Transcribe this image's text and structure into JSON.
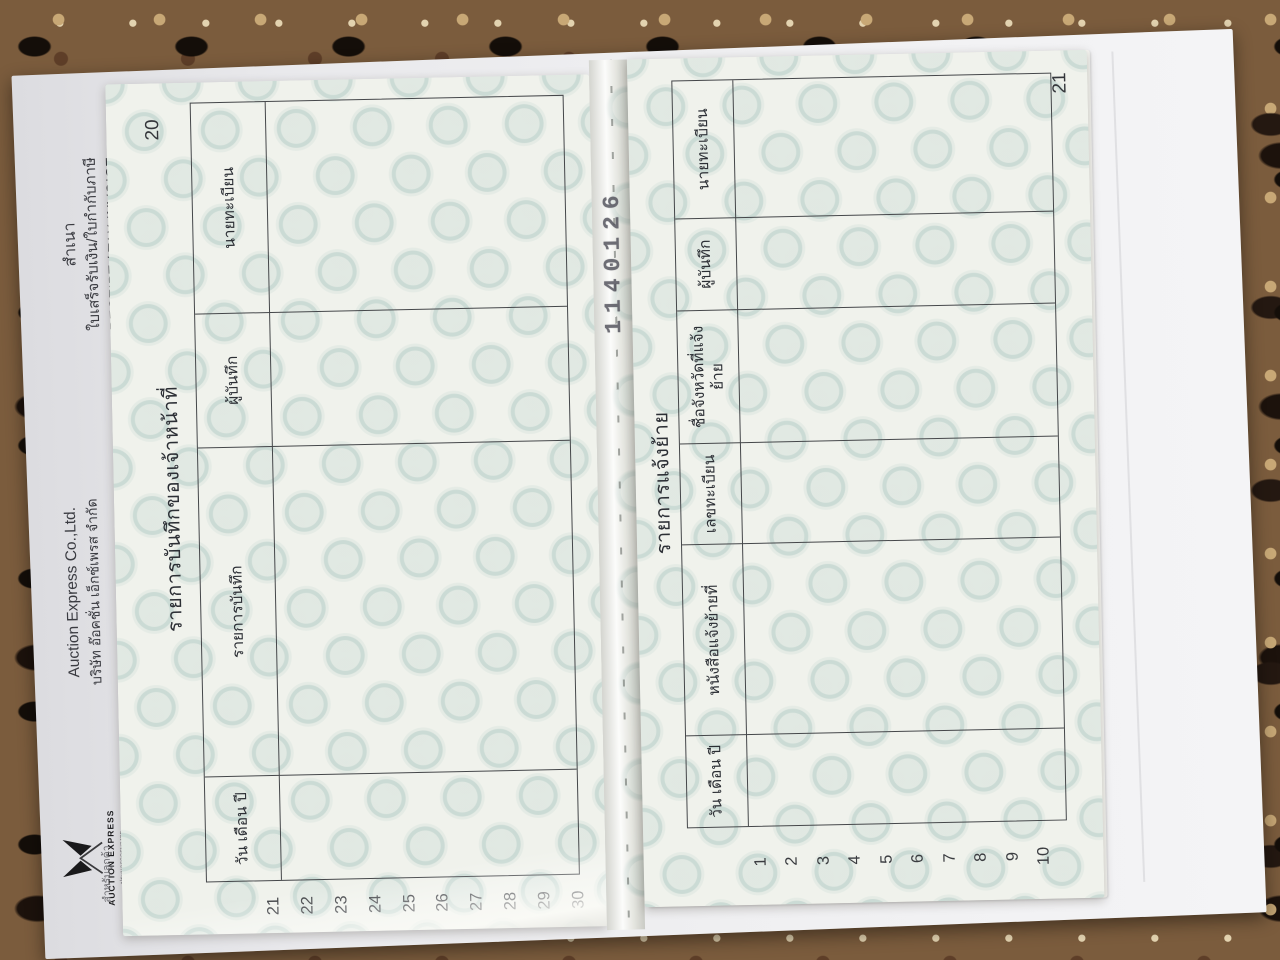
{
  "receipt": {
    "copy_label": "สำเนา",
    "doc_type_th": "ใบเสร็จรับเงิน/ใบกำกับภาษี",
    "doc_type_en": "RECEIPT / TAX INVOICE",
    "company_en": "Auction Express Co.,Ltd.",
    "company_th": "บริษัท อ๊อคชั่น เอ็กซ์เพรส จำกัด",
    "logo_text": "AUCTION EXPRESS",
    "logo_tagline": "ประมูลรถครบวงจร",
    "footer_note": "สำหรับลูกค้า"
  },
  "book": {
    "stamp_number": "1140126",
    "left_page": {
      "page_number": "20",
      "title": "รายการบันทึกของเจ้าหน้าที่",
      "columns": [
        "วัน เดือน ปี",
        "รายการบันทึก",
        "ผู้บันทึก",
        "นายทะเบียน"
      ],
      "row_numbers": [
        "21",
        "22",
        "23",
        "24",
        "25",
        "26",
        "27",
        "28",
        "29",
        "30"
      ]
    },
    "right_page": {
      "page_number": "21",
      "title": "รายการแจ้งย้าย",
      "columns": [
        "วัน เดือน ปี",
        "หนังสือแจ้งย้ายที่",
        "เลขทะเบียน",
        "ชื่อจังหวัดที่แจ้งย้าย",
        "ผู้บันทึก",
        "นายทะเบียน"
      ],
      "row_numbers": [
        "1",
        "2",
        "3",
        "4",
        "5",
        "6",
        "7",
        "8",
        "9",
        "10"
      ]
    },
    "colors": {
      "paper": "#f0f2ec",
      "seal_pattern": "#9cc2bb",
      "table_line": "#45474a",
      "stamp_ink": "#50505a"
    }
  }
}
